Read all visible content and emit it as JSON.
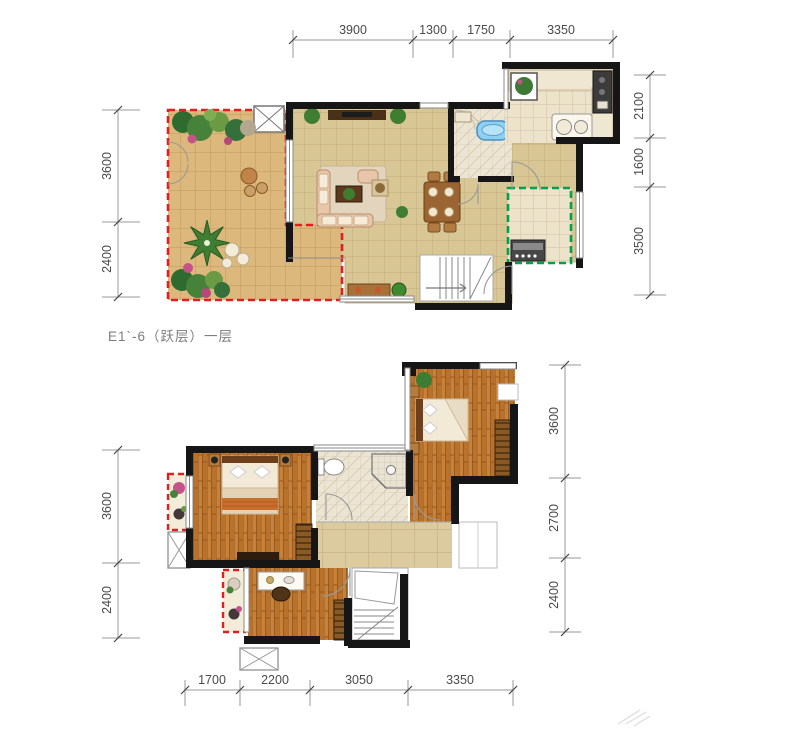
{
  "title_label": "E1`-6（跃层）一层",
  "floor1_dims": {
    "top": [
      "3900",
      "1300",
      "1750",
      "3350"
    ],
    "left": [
      "3600",
      "2400"
    ],
    "right": [
      "2100",
      "1600",
      "3500"
    ]
  },
  "floor2_dims": {
    "bottom": [
      "1700",
      "2200",
      "3050",
      "3350"
    ],
    "left": [
      "3600",
      "2400"
    ],
    "right": [
      "3600",
      "2700",
      "2400"
    ]
  },
  "icons": {
    "vent_shaft": "crossed-box",
    "stair_direction": "up-arrow"
  },
  "colors": {
    "wall": "#161616",
    "tile_floor": "#d8c694",
    "hall_tile": "#dbcb9e",
    "deck_floor": "#ddb87c",
    "kitchen_tile": "#ede3cb",
    "wood_floor": "#c6813a",
    "terrace_border": "#e02020",
    "utility_border": "#00a050",
    "tub_blue": "#8fd0f0",
    "plant_green": "#3e7d32",
    "dim_line": "#9a9a9a",
    "dim_text": "#4a4a4a",
    "title_text": "#7d7d7d"
  }
}
